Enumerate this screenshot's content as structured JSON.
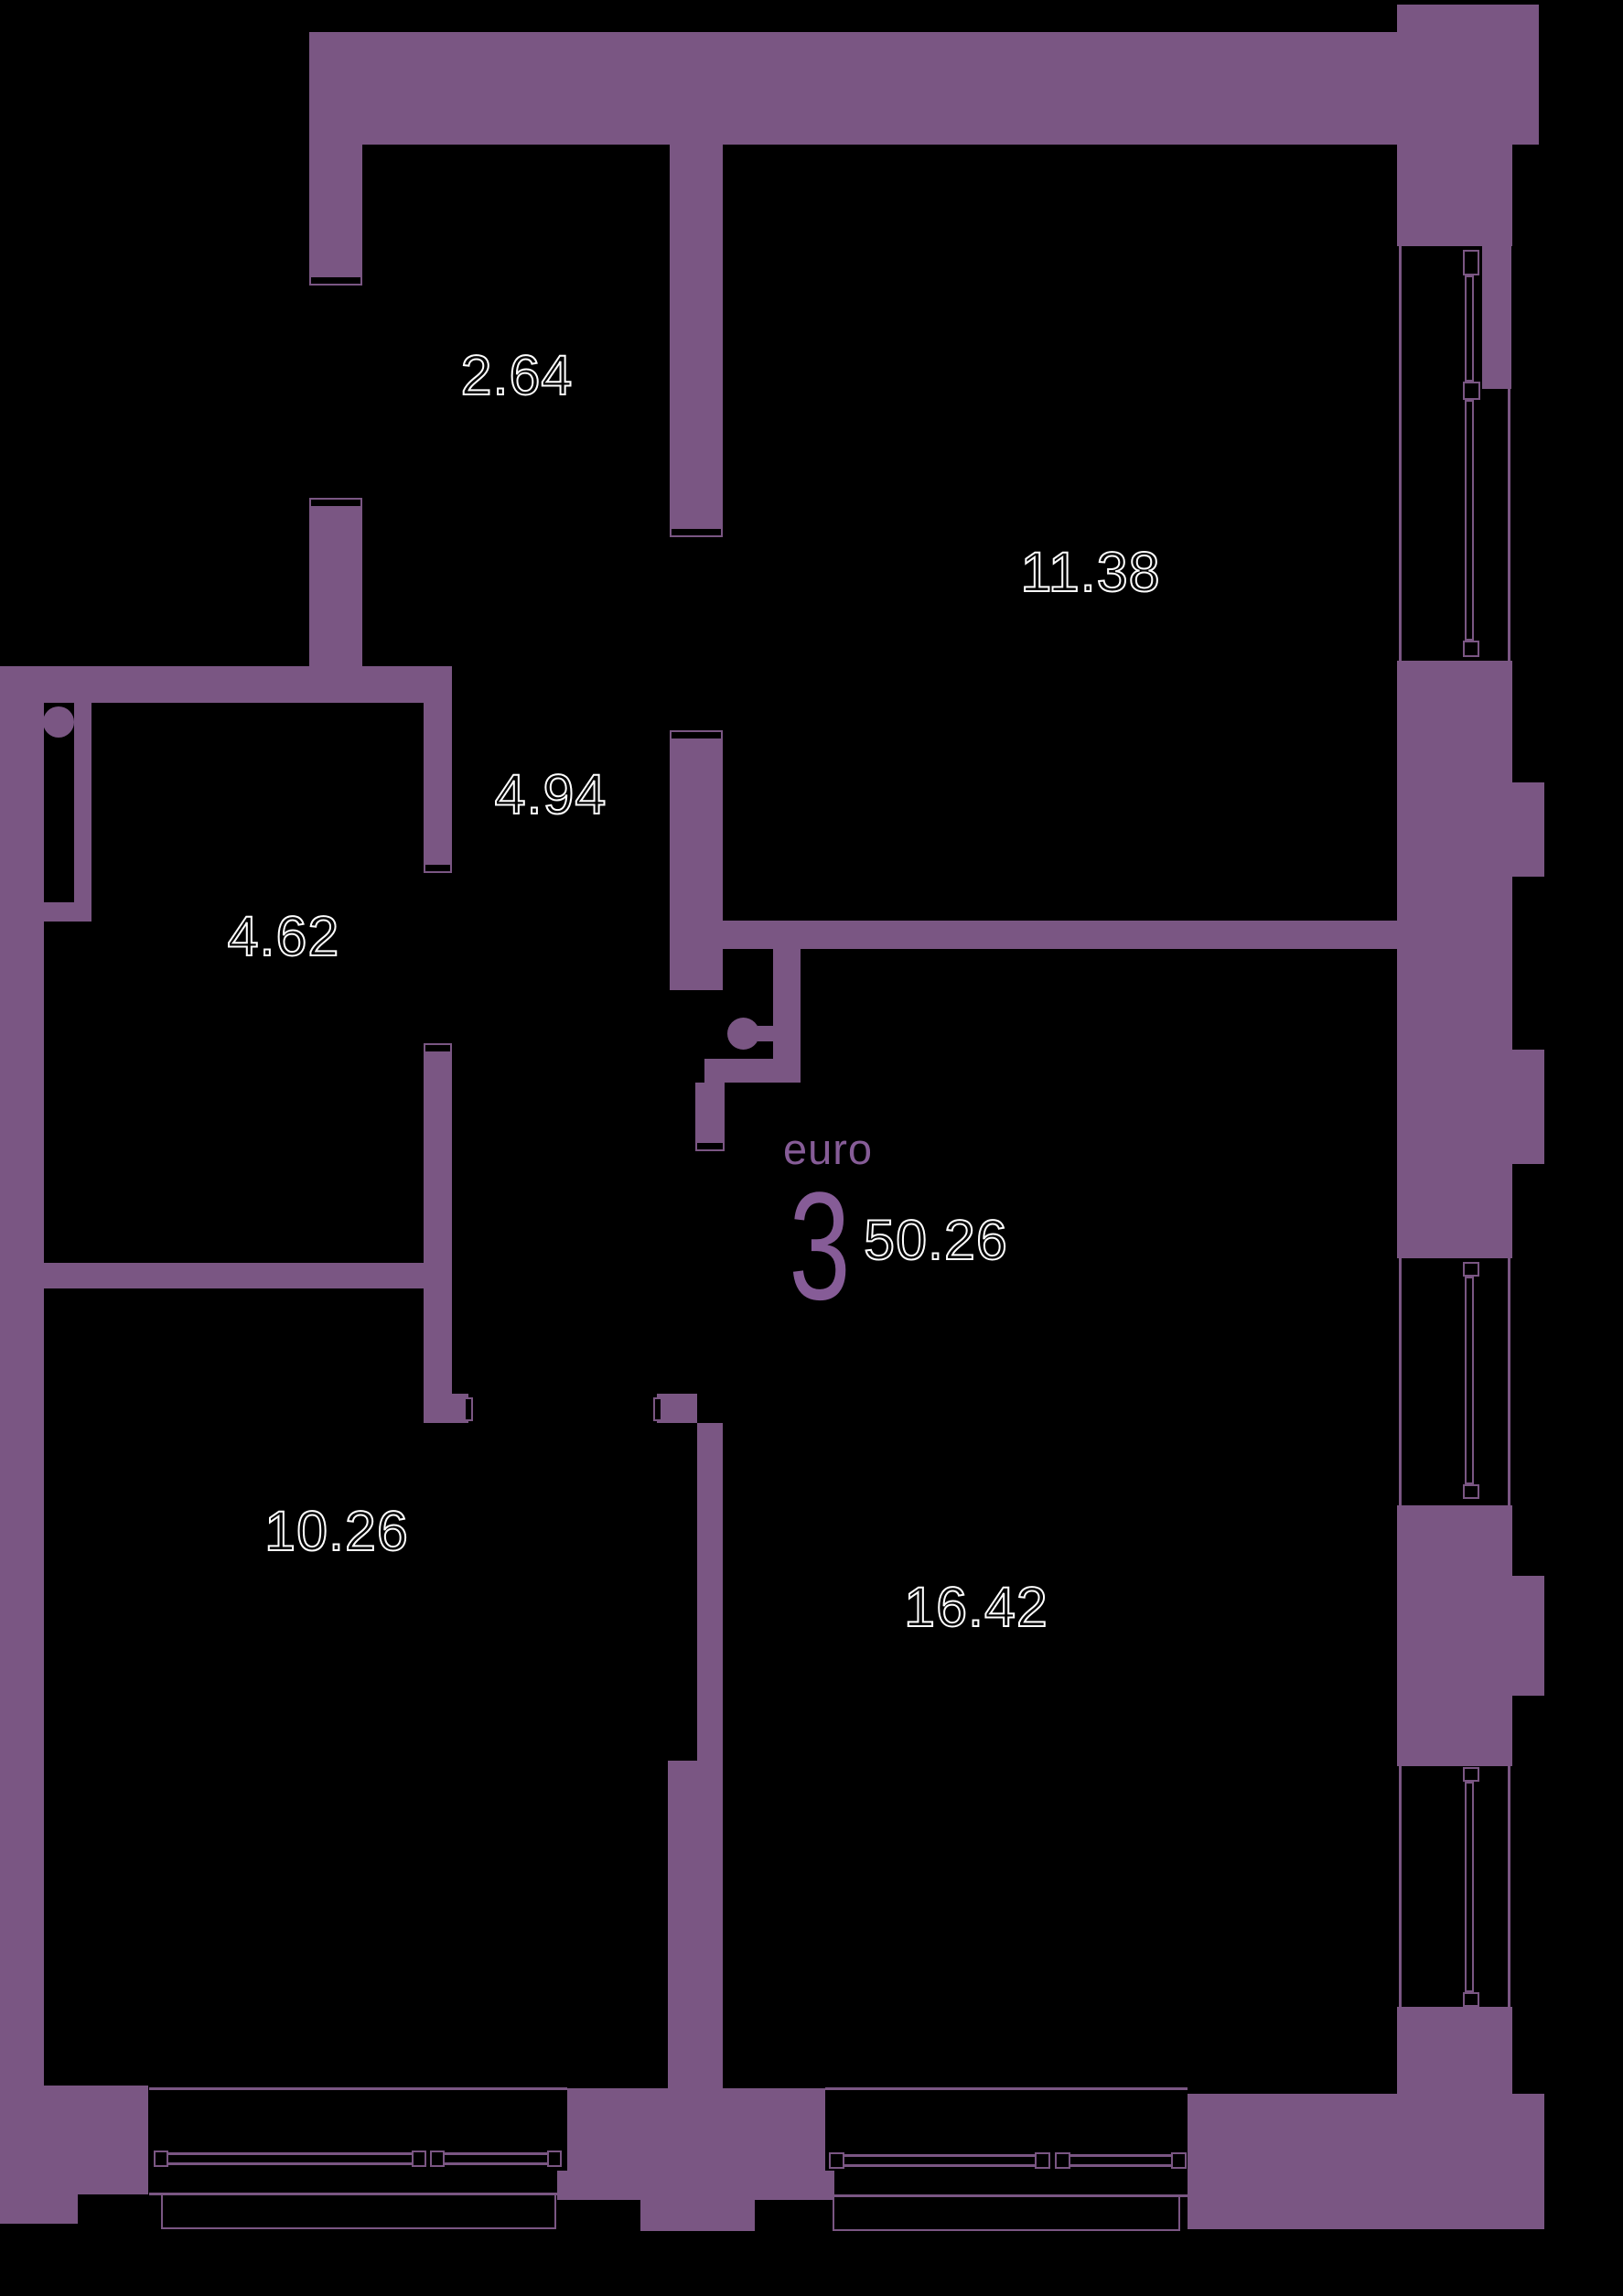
{
  "floor_plan": {
    "unit_label": "euro",
    "unit_number": "3",
    "total_area": "50.26",
    "room_areas": {
      "entry_closet": "2.64",
      "bedroom_top": "11.38",
      "hallway": "4.94",
      "bathroom": "4.62",
      "bedroom_bottom": "10.26",
      "living_room": "16.42"
    },
    "colors": {
      "wall": "#7a5683",
      "accent_text": "#865c97",
      "background": "#000000",
      "label_outline": "#ffffff"
    }
  }
}
